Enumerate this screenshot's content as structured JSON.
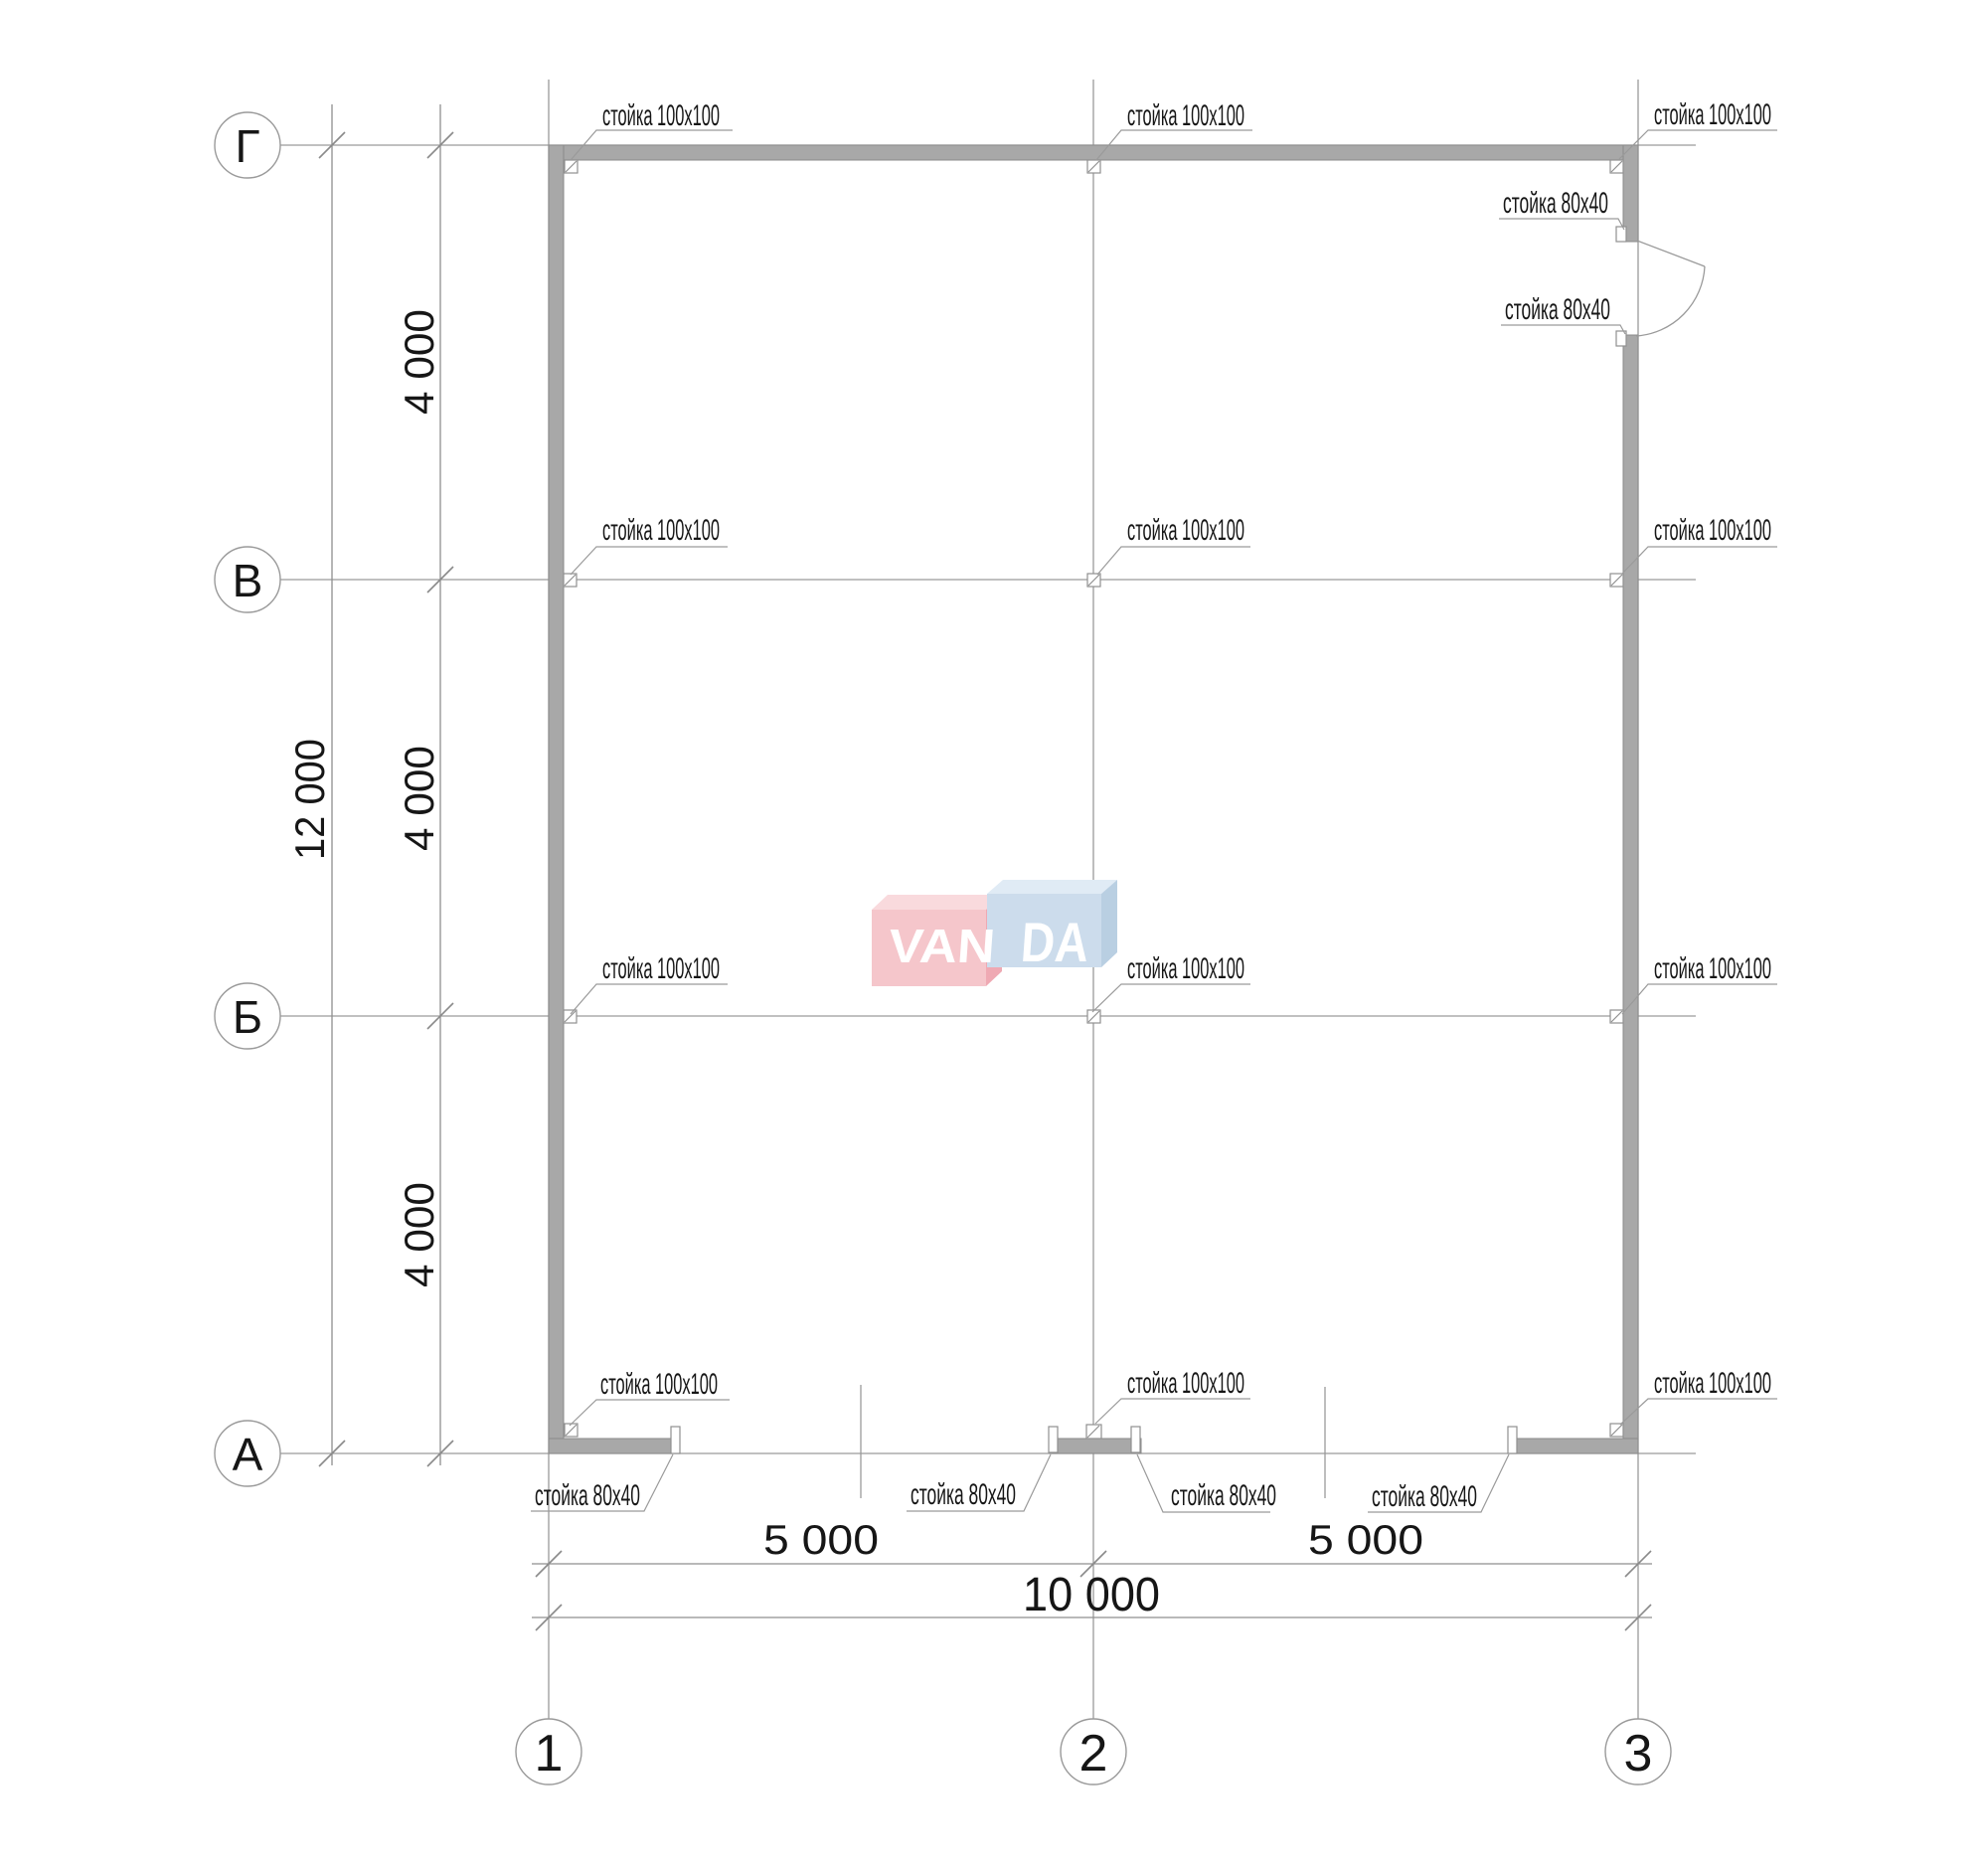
{
  "plan": {
    "labels": {
      "post_100": "стойка 100x100",
      "post_80": "стойка 80x40"
    },
    "row_axes": [
      {
        "label": "Г"
      },
      {
        "label": "В"
      },
      {
        "label": "Б"
      },
      {
        "label": "А"
      }
    ],
    "col_axes": [
      {
        "label": "1"
      },
      {
        "label": "2"
      },
      {
        "label": "3"
      }
    ],
    "dimensions": {
      "left_segments": [
        "4 000",
        "4 000",
        "4 000"
      ],
      "left_total": "12 000",
      "bottom_segments": [
        "5 000",
        "5 000"
      ],
      "bottom_total": "10 000"
    },
    "logo": {
      "left": "VAN",
      "right": "DA"
    },
    "colors": {
      "wall": "#a8a8a8",
      "wall_edge": "#8a8a8a",
      "line": "#9a9a9a",
      "pink_front": "#f5c6cb",
      "pink_top": "#f9dadd",
      "pink_side": "#efa9b3",
      "blue_front": "#ccdcec",
      "blue_top": "#e0ebf5",
      "blue_side": "#b9cfe2"
    }
  }
}
